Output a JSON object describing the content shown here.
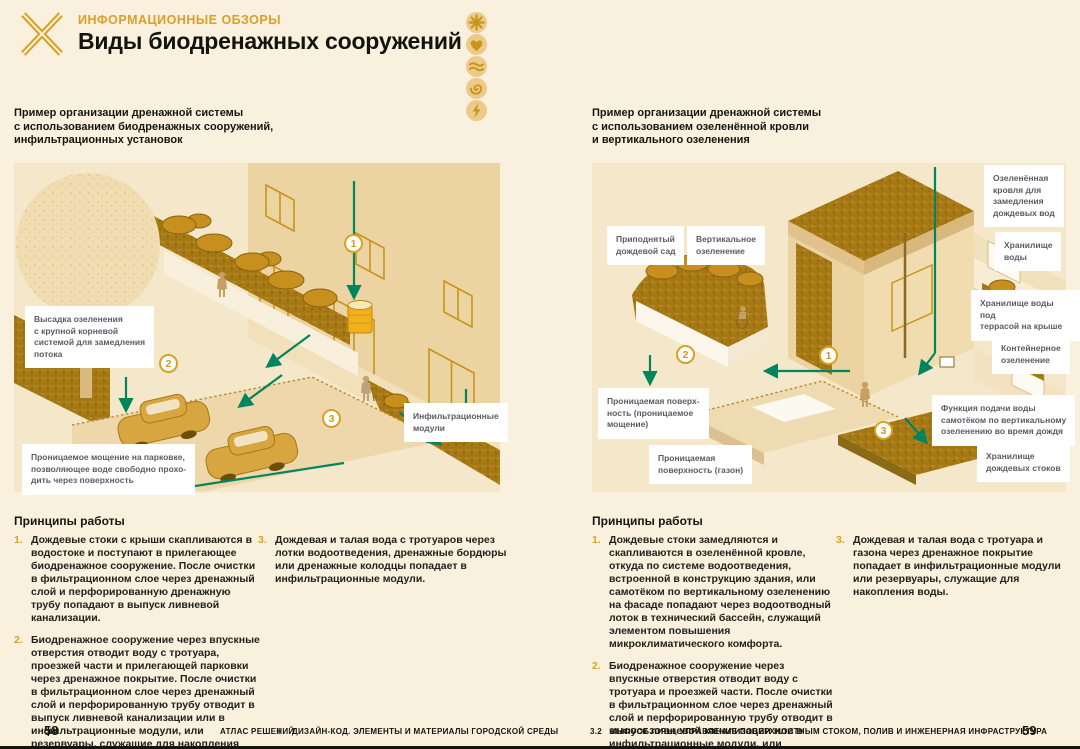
{
  "colors": {
    "page_bg": "#F9F1DE",
    "panel_bg": "#F5E7C9",
    "accent_gold": "#D9A126",
    "heading_gold": "#DB9F27",
    "arrow_teal": "#00855E",
    "vegetation_gold": "#A87A16",
    "wall_tan": "#ECD3A2",
    "text_dark": "#17150F",
    "callout_text": "#5B5B64",
    "icon_circle": "#ECCA8A",
    "icon_glyph": "#C8941C"
  },
  "header": {
    "eyebrow": "ИНФОРМАЦИОННЫЕ ОБЗОРЫ",
    "title": "Виды биодренажных сооружений",
    "corner_icons": [
      "sun-icon",
      "heart-icon",
      "waves-icon",
      "spiral-icon",
      "lightning-icon"
    ]
  },
  "left_page": {
    "intro": "Пример организации дренажной системы\nс использованием биодренажных сооружений,\nинфильтрационных установок",
    "callouts": [
      {
        "text": "Высадка озеленения\nс крупной корневой\nсистемой для замедления\nпотока"
      },
      {
        "text": "Проницаемое мощение на парковке,\nпозволяющее воде свободно прохо-\nдить через поверхность"
      },
      {
        "text": "Инфильтрационные\nмодули"
      }
    ],
    "markers": [
      "1",
      "2",
      "3"
    ],
    "principles": {
      "heading": "Принципы работы",
      "items": [
        {
          "num": "1.",
          "text": "Дождевые стоки с крыши скапливаются в водостоке и поступают в прилегающее биодренажное сооружение. После очистки в фильтрационном слое через дренажный слой и перфорированную дренажную трубу попадают в выпуск ливневой канализации."
        },
        {
          "num": "2.",
          "text": "Биодренажное сооружение через впускные отверстия отводит воду с тротуара, проезжей части и прилегающей парковки через дренажное покрытие. После очистки в фильтрационном слое через дренажный слой и перфорированную трубу отводит в выпуск ливневой канализации или в инфильтрационные модули, или резервуары, служащие для накопления воды."
        },
        {
          "num": "3.",
          "text": "Дождевая и талая вода с тротуаров через лотки водоотведения, дренажные бордюры или дренажные колодцы попадает в инфильтрационные модули."
        }
      ]
    },
    "footer": {
      "page_number": "58",
      "book_title": "АТЛАС РЕШЕНИЙ",
      "part_number": "I",
      "part_title": "ДИЗАЙН-КОД. ЭЛЕМЕНТЫ И МАТЕРИАЛЫ ГОРОДСКОЙ СРЕДЫ"
    }
  },
  "right_page": {
    "intro": "Пример организации дренажной системы\nс использованием озеленённой кровли\nи вертикального озеленения",
    "callouts": [
      {
        "text": "Приподнятый\nдождевой сад"
      },
      {
        "text": "Вертикальное\nозеленение"
      },
      {
        "text": "Озеленённая\nкровля для\nзамедления\nдождевых вод"
      },
      {
        "text": "Хранилище\nводы"
      },
      {
        "text": "Хранилище воды под\nтеррасой на крыше"
      },
      {
        "text": "Контейнерное\nозеленение"
      },
      {
        "text": "Проницаемая поверх-\nность (проницаемое\nмощение)"
      },
      {
        "text": "Функция подачи воды\nсамотёком по вертикальному\nозеленению во время дождя"
      },
      {
        "text": "Проницаемая\nповерхность (газон)"
      },
      {
        "text": "Хранилище\nдождевых стоков"
      }
    ],
    "markers": [
      "2",
      "1",
      "3"
    ],
    "principles": {
      "heading": "Принципы работы",
      "items": [
        {
          "num": "1.",
          "text": "Дождевые стоки замедляются и скапливаются в озеленённой кровле, откуда по системе водоотведения, встроенной в конструкцию здания, или самотёком по вертикальному озеленению на фасаде попадают через водоотводный лоток в технический бассейн, служащий элементом повышения микроклиматического комфорта."
        },
        {
          "num": "2.",
          "text": "Биодренажное сооружение через впускные отверстия отводит воду с тротуара и проезжей части. После очистки в фильтрационном слое через дренажный слой и перфорированную трубу отводит в выпуск ливневой канализации или в инфильтрационные модули, или резервуар, служащие для накопления воды."
        },
        {
          "num": "3.",
          "text": "Дождевая и талая вода с тротуара и газона через дренажное покрытие попадает в инфильтрационные модули или резервуары, служащие для накопления воды."
        }
      ]
    },
    "footer": {
      "section_number": "3.2",
      "section_title": "ИНФООБЗОРЫ, УПРАВЛЕНИЕ ПОВЕРХНОСТНЫМ СТОКОМ, ПОЛИВ И ИНЖЕНЕРНАЯ ИНФРАСТРУКТУРА",
      "page_number": "59"
    }
  }
}
